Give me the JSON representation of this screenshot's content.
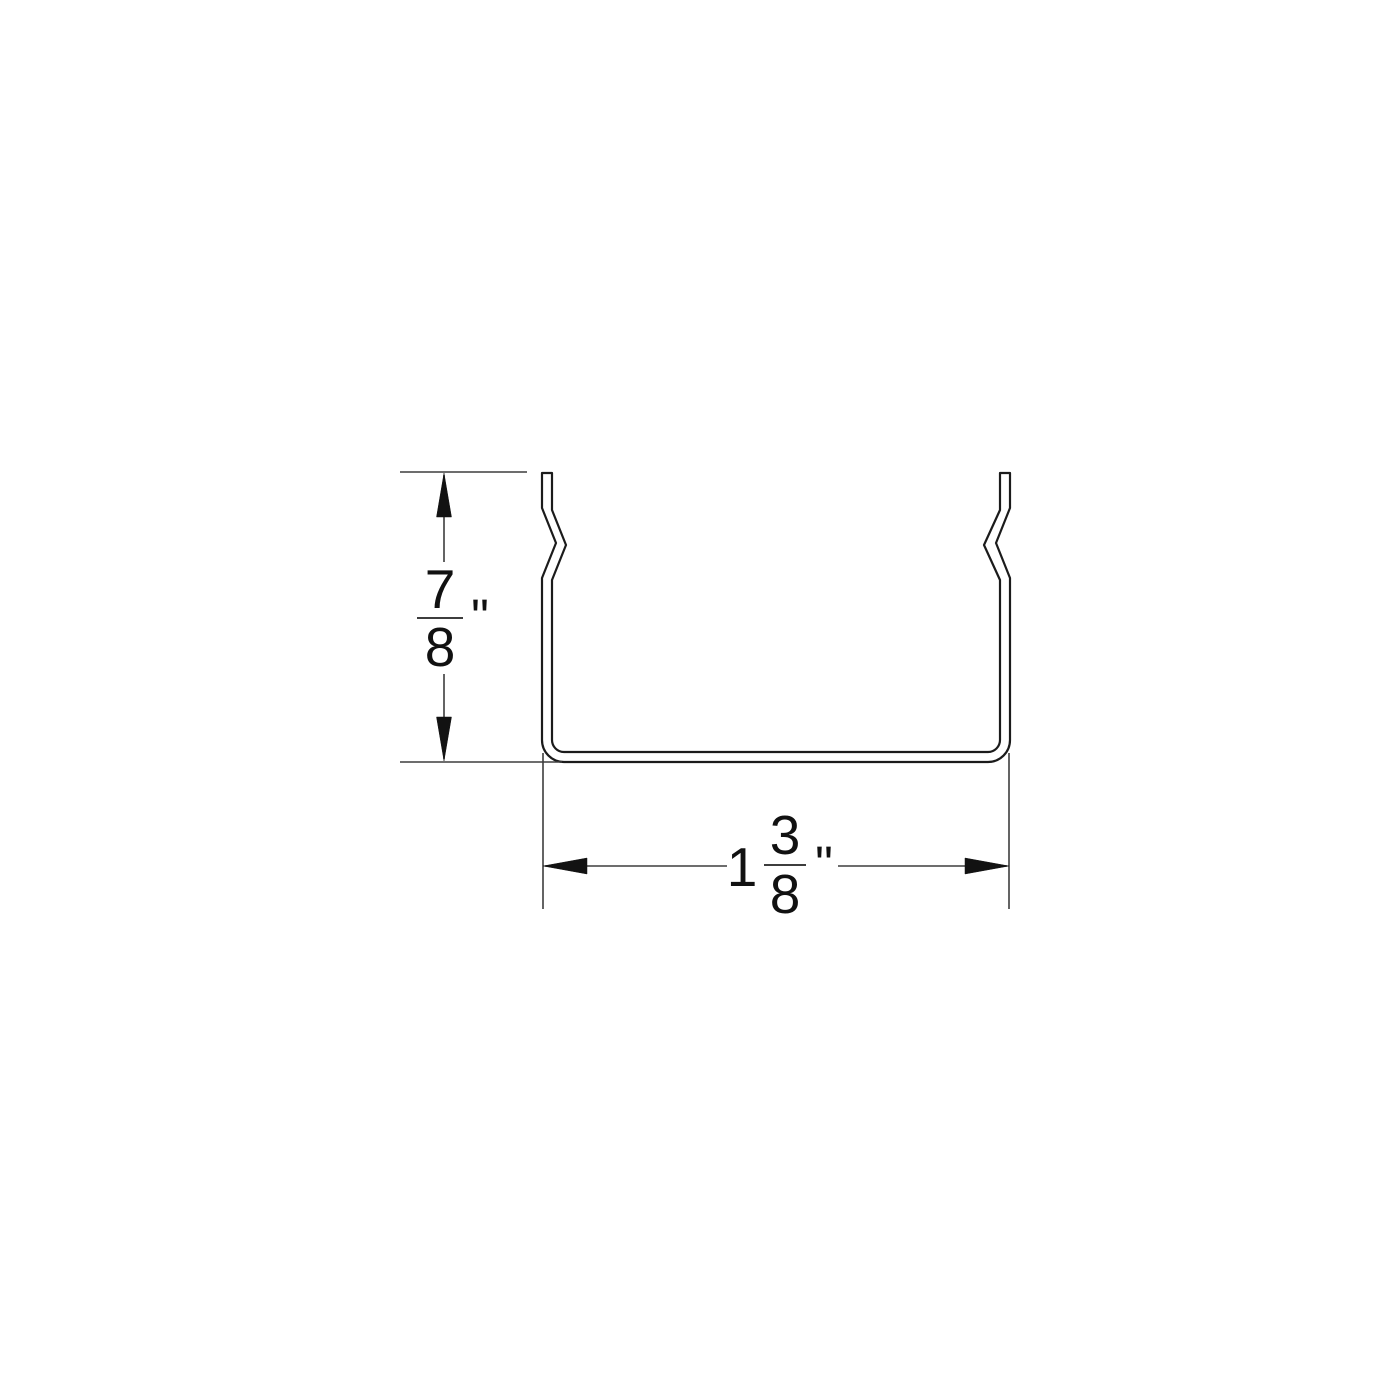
{
  "canvas": {
    "background": "#ffffff",
    "profile_line_color": "#1b1b1b",
    "dimension_line_color": "#3d3d3d",
    "text_color": "#111111",
    "profile_name": "u-channel-cross-section"
  },
  "height_dimension": {
    "numerator": "7",
    "denominator": "8",
    "unit_mark": "\"",
    "value_label": "7/8 inch"
  },
  "width_dimension": {
    "whole_number": "1",
    "numerator": "3",
    "denominator": "8",
    "unit_mark": "\"",
    "value_label": "1 3/8 inch"
  }
}
